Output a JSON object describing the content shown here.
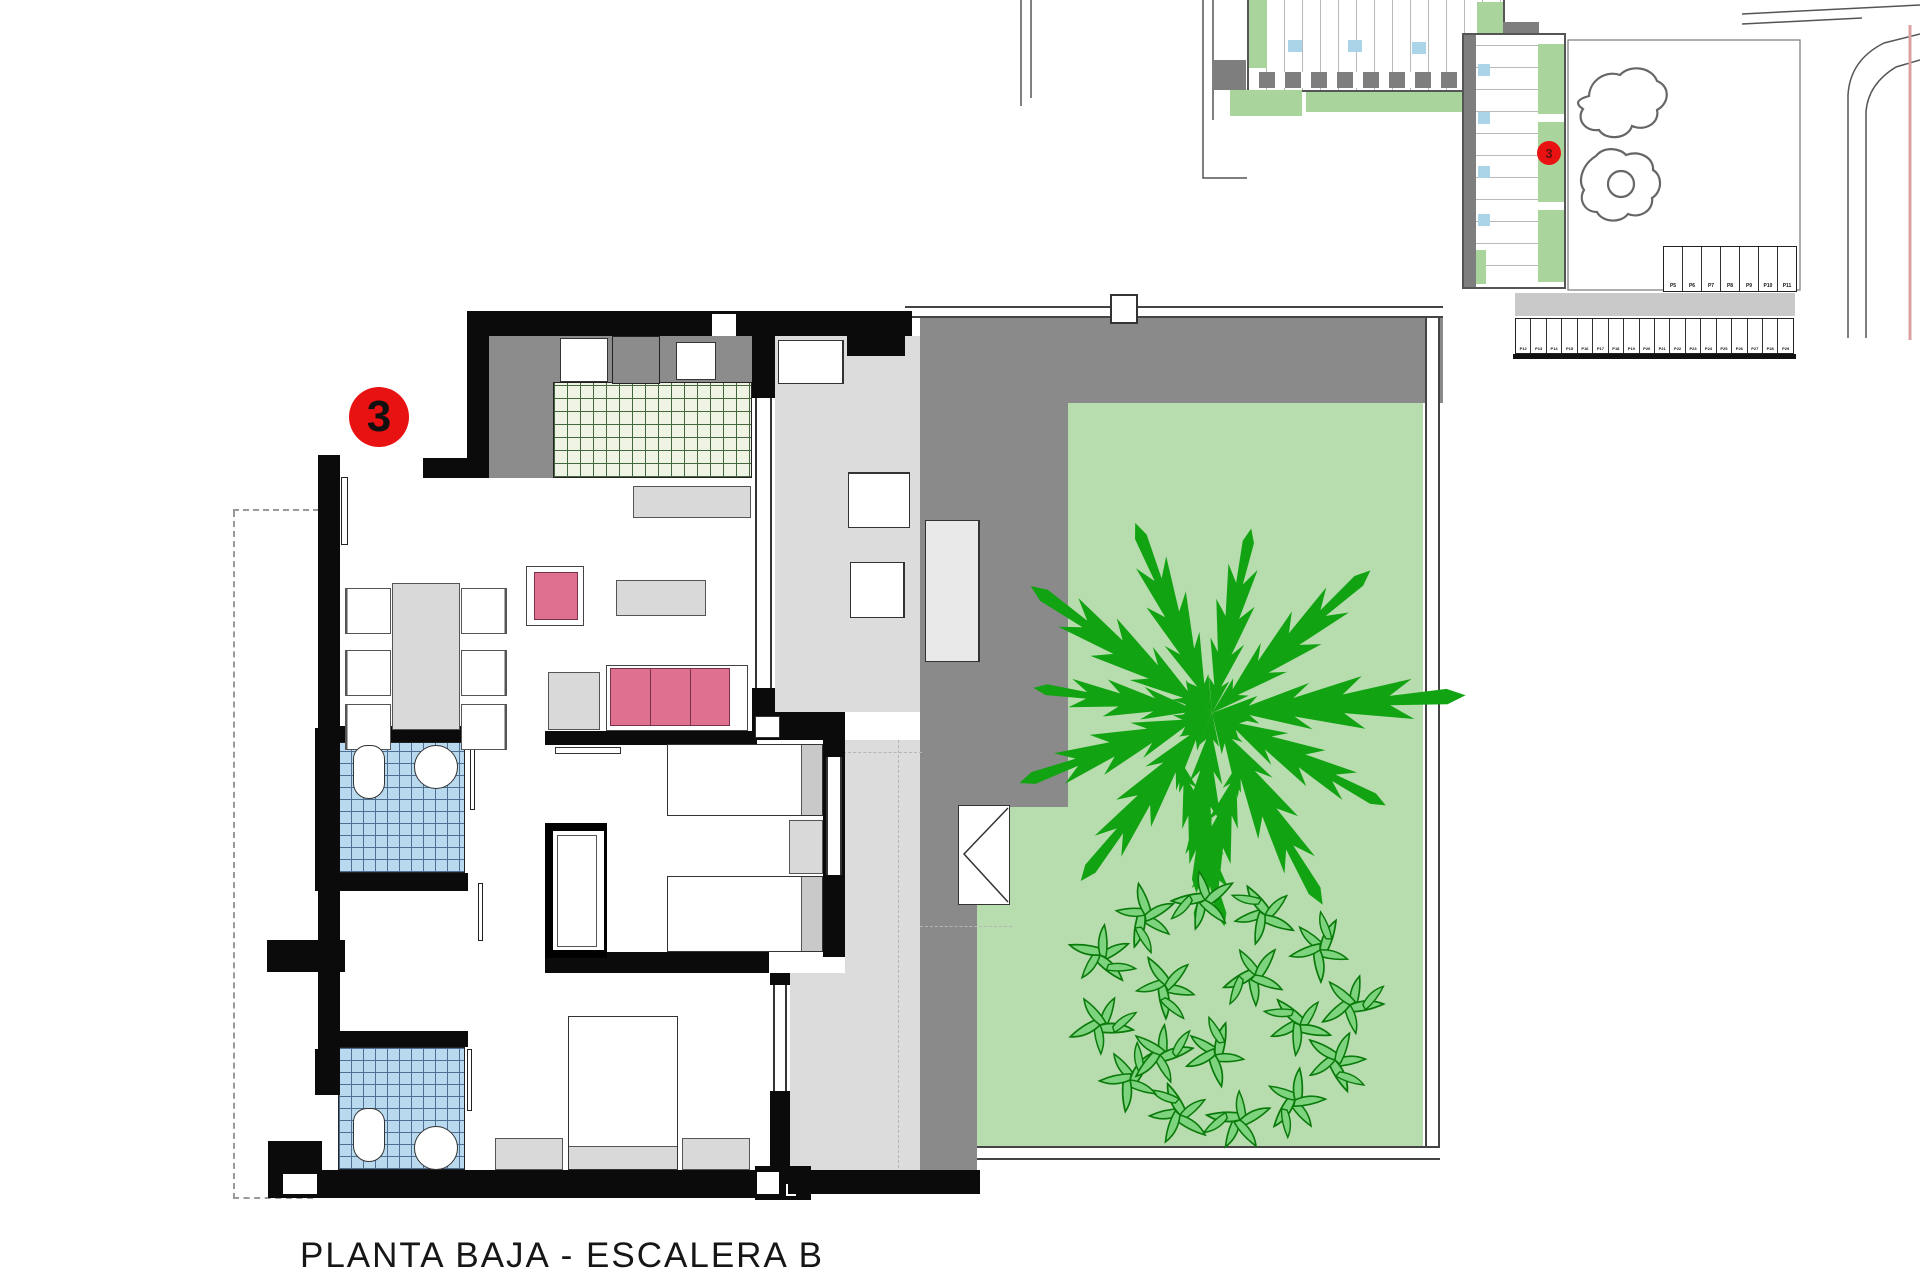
{
  "title": "PLANTA BAJA - ESCALERA B",
  "unit_badge": "3",
  "site_plan": {
    "unit_badge": "3",
    "parking_row_upper": [
      "P5",
      "P6",
      "P7",
      "P8",
      "P9",
      "P10",
      "P11"
    ],
    "parking_row_lower": [
      "P12",
      "P13",
      "P14",
      "P15",
      "P16",
      "P17",
      "P18",
      "P19",
      "P20",
      "P21",
      "P22",
      "P23",
      "P24",
      "P25",
      "P26",
      "P27",
      "P28",
      "P29"
    ]
  },
  "colors": {
    "red": "#e81212",
    "wall": "#0b0b0b",
    "garden": "#b7dcae",
    "tree": "#12a312",
    "leaf_fill": "#7ed47e",
    "leaf_stroke": "#0a7a0a",
    "terrace": "#dcdcdc",
    "paving": "#8a8a8a",
    "porch": "#8c8c8c",
    "kitchen_tile": "#eef3e4",
    "kitchen_line": "#44663f",
    "bath_tile": "#b9d9ee",
    "bath_line": "#4c6f92",
    "pink": "#e0708f",
    "furn": "#d9d9d9",
    "site_green": "#a9d49b",
    "site_blue": "#aad4e8",
    "boundary_pink": "#dca0a0"
  }
}
